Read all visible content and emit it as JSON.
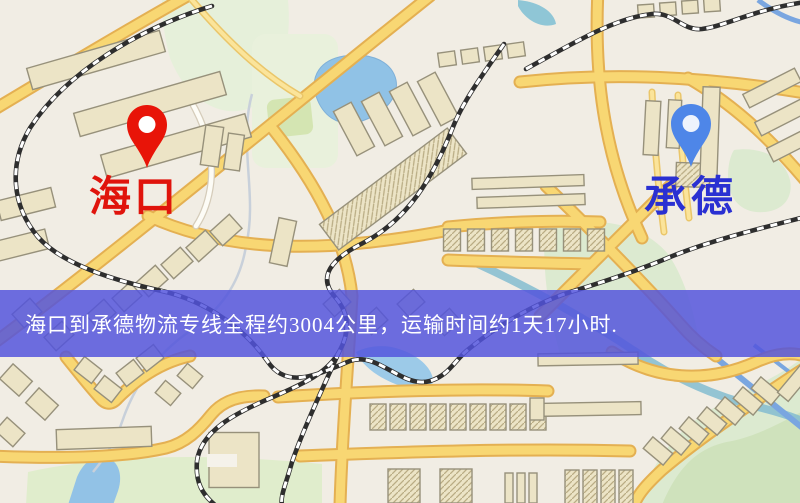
{
  "banner": {
    "text": "海口到承德物流专线全程约3004公里，运输时间约1天17小时."
  },
  "route": {
    "origin": "海口",
    "destination": "承德",
    "distance_km": "3004",
    "duration": "1天17小时"
  },
  "markers": {
    "origin": {
      "label": "海口",
      "pin_color": "#e81408",
      "label_color": "#e0140c"
    },
    "destination": {
      "label": "承德",
      "pin_color": "#4e86e8",
      "label_color": "#2a30d2"
    }
  },
  "map_colors": {
    "background": "#f1ede4",
    "road_fill": "#f8d773",
    "road_casing": "#e4b052",
    "water": "#90c2e6",
    "park": "#dcead0",
    "railway": "#2e2e2e",
    "building": "#ece4c6",
    "banner_background": "#5253dd",
    "banner_text": "#ffffff"
  }
}
